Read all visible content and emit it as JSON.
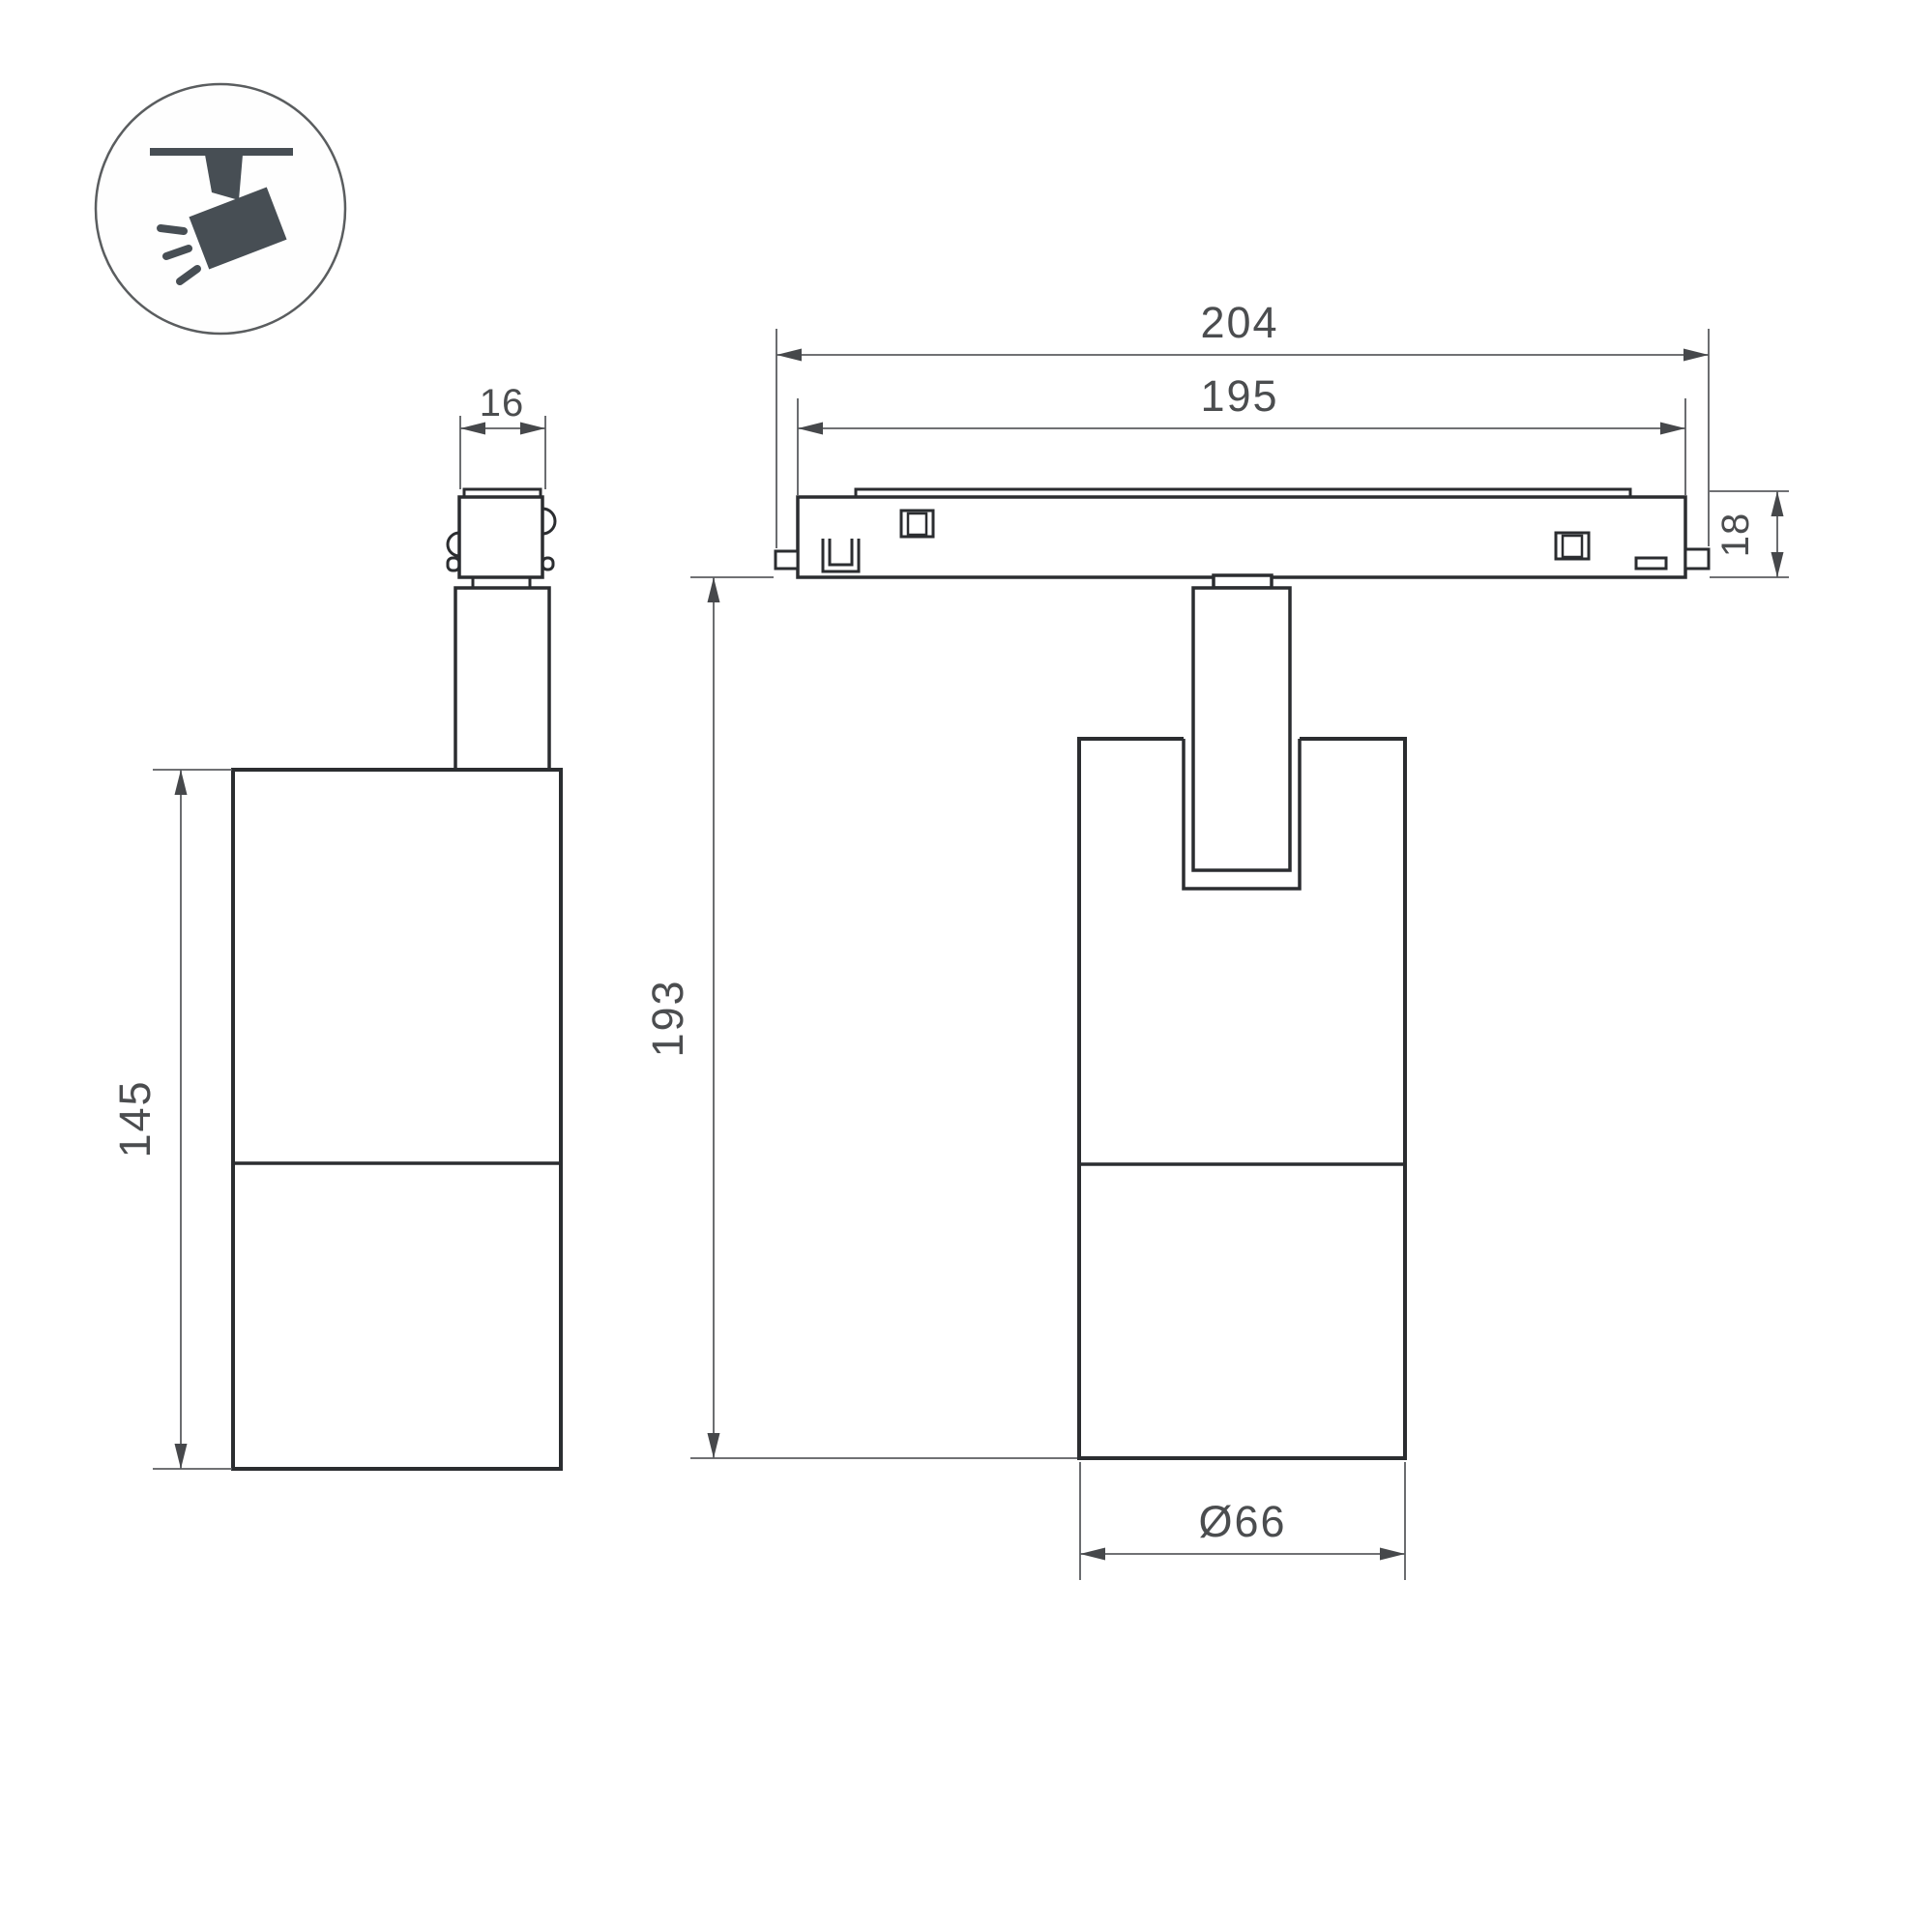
{
  "page": {
    "background": "#ffffff",
    "type_note": "technical dimension drawing of a magnetic track spotlight, two orthographic views"
  },
  "colors": {
    "object_line": "#2b2d30",
    "dimension_line": "#5b5d60",
    "arrow_fill": "#46484b",
    "label_text": "#4b4d4f",
    "icon_fill": "#474e54",
    "icon_circle_stroke": "#5a5d5f"
  },
  "icon": {
    "name": "ceiling-track-spotlight-pictogram",
    "description": "circle badge with ceiling line, mount stem and tilted spotlight head emitting rays"
  },
  "views": {
    "side_view": {
      "dim_adapter_width": "16",
      "dim_body_height": "145"
    },
    "front_view": {
      "dim_track_outer_length": "204",
      "dim_track_inner_length": "195",
      "dim_track_height": "18",
      "dim_overall_height": "193",
      "dim_body_diameter": "Ø66"
    }
  }
}
